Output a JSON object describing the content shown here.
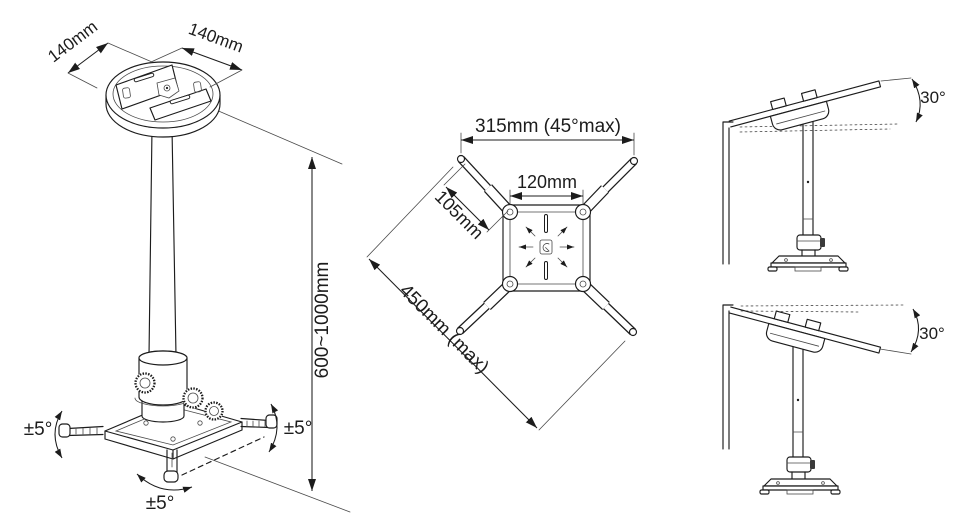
{
  "drawing": {
    "subject": "projector-ceiling-mount-dimension-drawing",
    "line_color": "#1c1c1c",
    "background": "#ffffff"
  },
  "views": {
    "perspective": {
      "name": "perspective view of ceiling mount",
      "labels": {
        "plate_width_left": "140mm",
        "plate_width_right": "140mm",
        "height_range": "600~1000mm",
        "tilt_left": "±5°",
        "tilt_right": "±5°",
        "swivel_bottom": "±5°"
      }
    },
    "top": {
      "name": "top view of spider bracket",
      "labels": {
        "max_width": "315mm (45°max)",
        "plate_size": "120mm",
        "arm_length": "105mm",
        "max_diagonal": "450mm (max)"
      }
    },
    "side_tilt_up": {
      "name": "side view on upward sloped ceiling",
      "labels": {
        "angle": "30°"
      }
    },
    "side_tilt_down": {
      "name": "side view on downward sloped ceiling",
      "labels": {
        "angle": "30°"
      }
    }
  }
}
